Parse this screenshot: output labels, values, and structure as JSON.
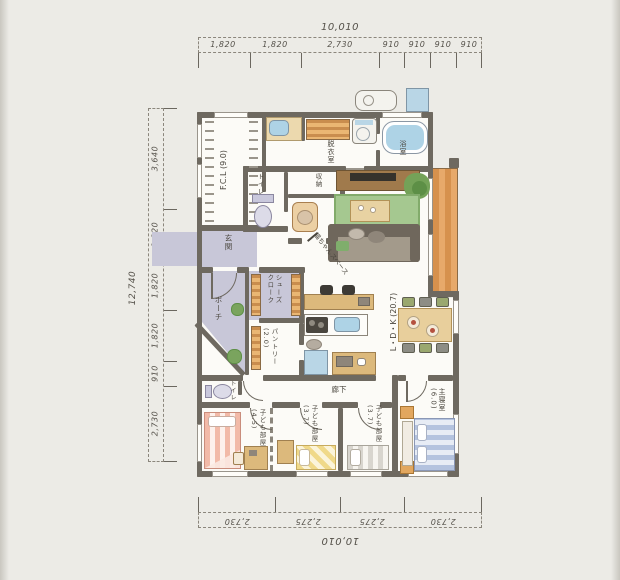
{
  "plan": {
    "rooms": {
      "fcl": "F.C.L (9.0)",
      "laundry_room": "脱衣室",
      "bathroom": "浴室",
      "toilet_upper": "トイレ",
      "storage": "収納",
      "cat_space": "猫ちゃんスペース",
      "entrance": "玄関",
      "porch": "ポーチ",
      "shoe_closet": "シューズ\nクローク",
      "pantry": "パントリー\n(2.0)",
      "ldk": "L・D・K (20.7)",
      "hallway": "廊下",
      "toilet_lower": "トイレ",
      "kids_room_1": "子ども部屋\n(4.5)",
      "kids_room_2": "子ども部屋\n(3.7)",
      "kids_room_3": "子ども部屋\n(3.7)",
      "master_bedroom": "主寝室\n(6.0)"
    },
    "dimensions": {
      "top": {
        "total": "10,010",
        "segments": [
          "1,820",
          "1,820",
          "2,730",
          "910",
          "910",
          "910",
          "910"
        ]
      },
      "left": {
        "total": "12,740",
        "segments": [
          "3,640",
          "1,820",
          "1,820",
          "1,820",
          "910",
          "2,730"
        ]
      },
      "bottom": {
        "total": "10,010",
        "segments": [
          "2,730",
          "2,275",
          "2,275",
          "2,730"
        ]
      }
    },
    "colors": {
      "wall": "#6e6960",
      "entrance_floor": "#c8c7d8",
      "wood_deck": "#d6914d",
      "rug_green": "#a5c890",
      "water_blue": "#aed3e6"
    }
  }
}
